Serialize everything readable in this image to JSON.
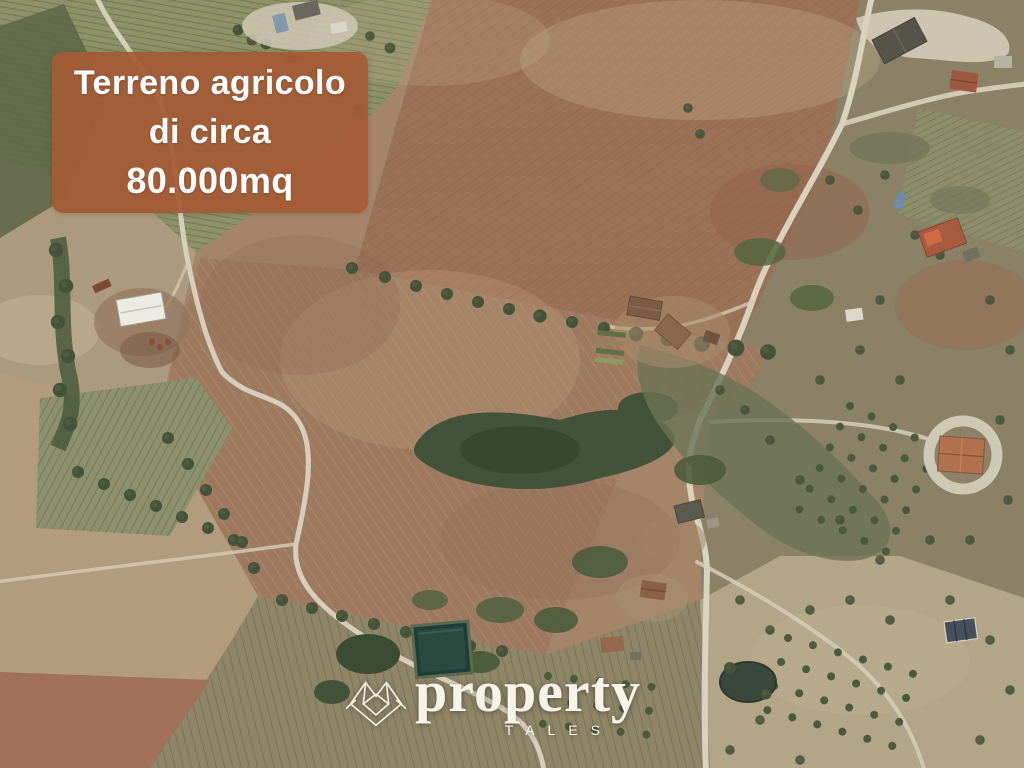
{
  "banner": {
    "line1": "Terreno agricolo",
    "line2": "di circa",
    "line3": "80.000mq",
    "background_color": "#A45A35",
    "text_color": "#FFFFFF"
  },
  "logo": {
    "brand": "property",
    "sub_brand": "TALES",
    "color": "#F7F3EA",
    "icon": "folded-map-outline-icon"
  },
  "terrain": {
    "type": "satellite-aerial-photo",
    "visible_features": [
      "large plowed brown field (the advertised parcel)",
      "vineyard rows top-left",
      "white-roof farm warehouse",
      "winding rural road on the left",
      "rural road on the right with house clusters",
      "diagonal tree line across the field",
      "woodland patch at center",
      "central farmstead with garden plots",
      "round courtyard villa on the right",
      "irrigation pond / pool bottom-center",
      "orchard tree grids bottom and right",
      "scattered olive trees"
    ],
    "palette": {
      "plowed_field": "#9D7A5F",
      "reddish_field": "#9B7158",
      "vineyard_green": "#8D9168",
      "scrub": "#8A8166",
      "pale_soil": "#B39B7D",
      "road": "#DAD2BF",
      "tree": "#44533A",
      "water": "#24403A",
      "roof_terracotta": "#B0714C",
      "roof_white": "#E9E7DF"
    }
  }
}
